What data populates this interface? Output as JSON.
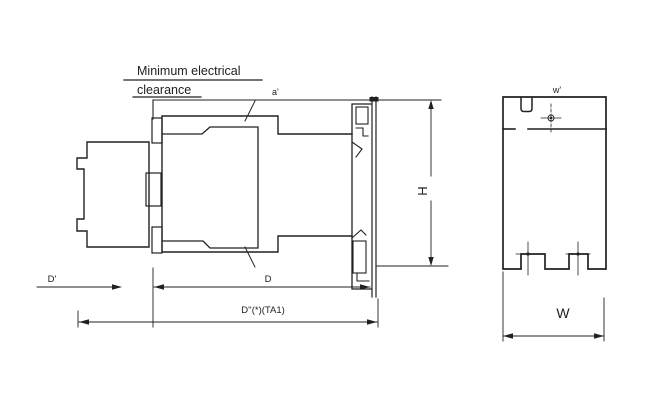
{
  "drawing": {
    "colors": {
      "background": "#ffffff",
      "ink": "#212121"
    },
    "note": {
      "line1": "Minimum electrical",
      "line2": "clearance"
    },
    "side_view": {
      "labels": {
        "clearance_gap": "a'",
        "height": "H",
        "depth_coil_end": "D'",
        "depth_body": "D",
        "depth_overall": "D''(*)(TA1)"
      }
    },
    "front_view": {
      "labels": {
        "width_top": "w'",
        "width_overall": "W"
      }
    }
  }
}
